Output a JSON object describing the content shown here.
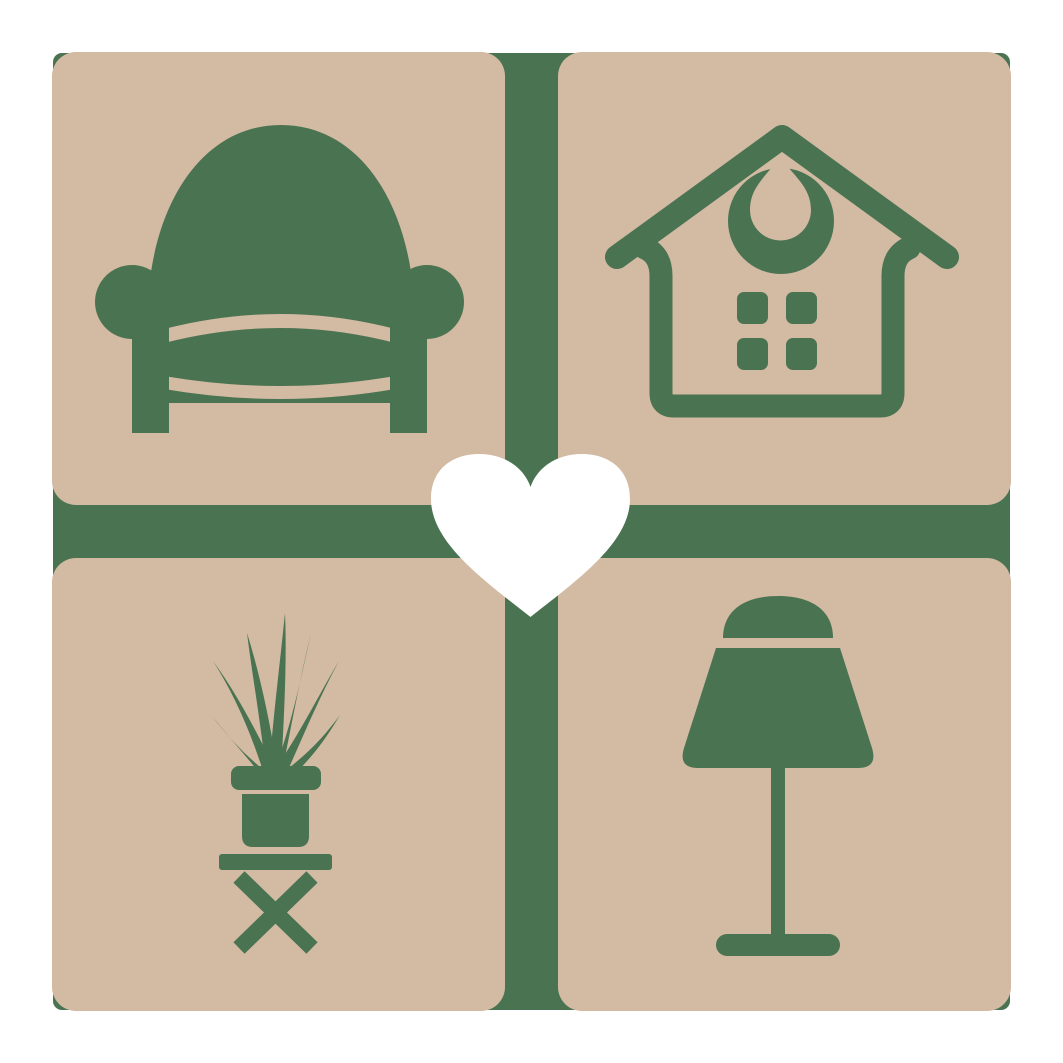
{
  "logo": {
    "name": "home-living-logo",
    "colors": {
      "tan": "#d2baa3",
      "green": "#4a7351",
      "white": "#ffffff",
      "page-bg": "#ffffff"
    },
    "tiles": [
      {
        "position": "top-left",
        "icon": "armchair-icon",
        "label": "Armchair"
      },
      {
        "position": "top-right",
        "icon": "house-icon",
        "label": "House"
      },
      {
        "position": "bottom-left",
        "icon": "potted-plant-icon",
        "label": "Potted plant on stool"
      },
      {
        "position": "bottom-right",
        "icon": "table-lamp-icon",
        "label": "Table lamp"
      }
    ],
    "center": {
      "icon": "heart-icon",
      "label": "Heart"
    }
  }
}
